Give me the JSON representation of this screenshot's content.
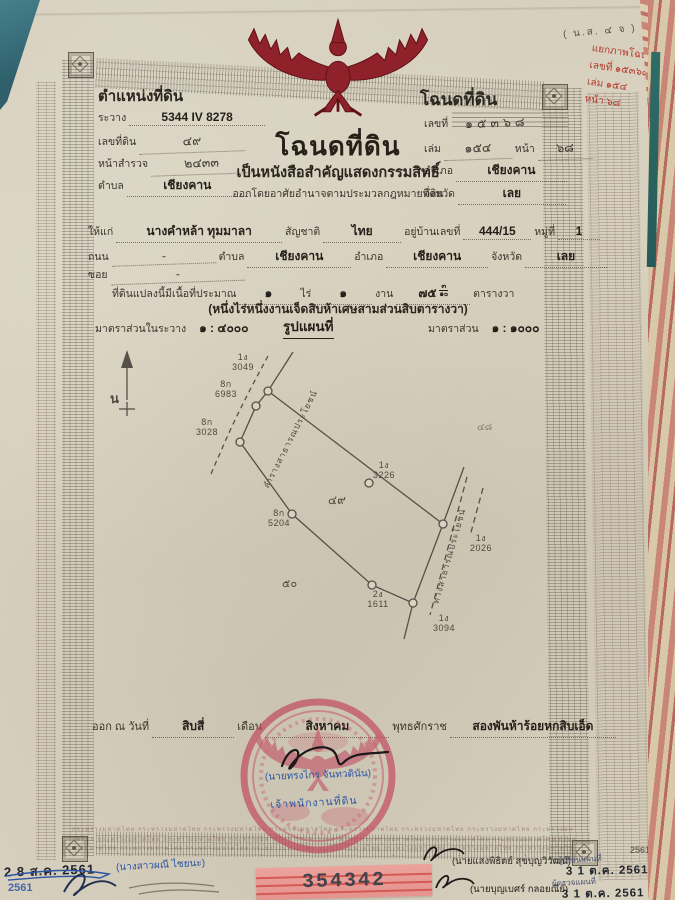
{
  "doc": {
    "form_code": "( น.ส. ๔ จ )",
    "header_left": {
      "title": "ตำแหน่งที่ดิน",
      "sheet_label": "ระวาง",
      "sheet_value": "5344 IV 8278",
      "parcel_label": "เลขที่ดิน",
      "parcel_value": "๔๙",
      "survey_label": "หน้าสำรวจ",
      "survey_value": "๒๔๓๓",
      "tambon_label": "ตำบล",
      "tambon_value": "เชียงคาน"
    },
    "header_right": {
      "title": "โฉนดที่ดิน",
      "no_label": "เลขที่",
      "no_value": "๑๕๓๖๘",
      "book_label": "เล่ม",
      "book_value": "๑๕๔",
      "page_label": "หน้า",
      "page_value": "๖๘",
      "amphoe_label": "อำเภอ",
      "amphoe_value": "เชียงคาน",
      "province_label": "จังหวัด",
      "province_value": "เลย"
    },
    "red_note": {
      "line1": "แยกภาพโฉนด",
      "line2": "เลขที่ ๑๕๓๖๘",
      "line3": "เล่ม ๑๕๔",
      "line4": "หน้า ๖๘"
    },
    "title_block": {
      "main": "โฉนดที่ดิน",
      "sub1": "เป็นหนังสือสำคัญแสดงกรรมสิทธิ์",
      "sub2": "ออกโดยอาศัยอำนาจตามประมวลกฎหมายที่ดิน"
    },
    "owner": {
      "grantee_label": "ให้แก่",
      "name": "นางคำหล้า ทุมมาลา",
      "nationality_label": "สัญชาติ",
      "nationality": "ไทย",
      "address_label": "อยู่บ้านเลขที่",
      "address_no": "444/15",
      "moo_label": "หมู่ที่",
      "moo": "1",
      "road_label": "ถนน",
      "road": "-",
      "soi_label": "ซอย",
      "soi": "-",
      "tambon_label": "ตำบล",
      "tambon": "เชียงคาน",
      "amphoe_label": "อำเภอ",
      "amphoe": "เชียงคาน",
      "province_label": "จังหวัด",
      "province": "เลย"
    },
    "area": {
      "intro": "ที่ดินแปลงนี้มีเนื้อที่ประมาณ",
      "rai_value": "๑",
      "rai_label": "ไร่",
      "ngan_value": "๑",
      "ngan_label": "งาน",
      "wa_value": "๗๕",
      "wa_frac_num": "๓",
      "wa_frac_den": "๑๐",
      "wa_label": "ตารางวา",
      "text": "(หนึ่งไร่หนึ่งงานเจ็ดสิบห้าเศษสามส่วนสิบตารางวา)"
    },
    "scale": {
      "sheet_label": "มาตราส่วนในระวาง",
      "sheet_value": "๑ : ๔๐๐๐",
      "map_title": "รูปแผนที่",
      "map_label": "มาตราส่วน",
      "map_value": "๑ : ๑๐๐๐"
    },
    "map": {
      "north_label": "น",
      "canal_label": "ลำรางสาธารณประโยชน์",
      "road_label": "ทางสาธารณประโยชน์",
      "parcel_no": "๔๙",
      "neighbor_sw": "๕๐",
      "neighbor_ne": "๔๘",
      "markers": [
        {
          "id": "1ง",
          "no": "3049"
        },
        {
          "id": "8ก",
          "no": "6983"
        },
        {
          "id": "8ก",
          "no": "3028"
        },
        {
          "id": "8ก",
          "no": "5204"
        },
        {
          "id": "1ง",
          "no": "3226"
        },
        {
          "id": "2ง",
          "no": "1611"
        },
        {
          "id": "1ง",
          "no": "2026"
        },
        {
          "id": "1ง",
          "no": "3094"
        }
      ]
    },
    "issue": {
      "prefix": "ออก ณ วันที่",
      "day": "สิบสี่",
      "month_label": "เดือน",
      "month": "สิงหาคม",
      "era_label": "พุทธศักราช",
      "year": "สองพันห้าร้อยหกสิบเอ็ด"
    },
    "seal": {
      "officer_name": "(นายทรงไกร จันทวดินัน)",
      "officer_title": "เจ้าพนักงานที่ดิน"
    },
    "microprint": "กระทรวงมหาดไทย",
    "bottom": {
      "stamp_left": "2 8 ส.ค. 2561",
      "stamp_left_partial": "2561",
      "clerk_name": "(นางสาวผณี ไชยนะ)",
      "officer1_name": "(นายแสงพิธิตย์ สุขบุญวิวัฒน์)",
      "officer2_name": "(นายบุญเบศร์ กลอยณีย์)",
      "note1": "ผู้เขียนแผนที่",
      "note2": "ผู้ตรวจแผนที่",
      "date_stamp1": "3 1 ต.ค. 2561",
      "date_stamp2": "3 1 ต.ค. 2561",
      "stamp_right_partial": "2561",
      "serial": "354342"
    }
  }
}
